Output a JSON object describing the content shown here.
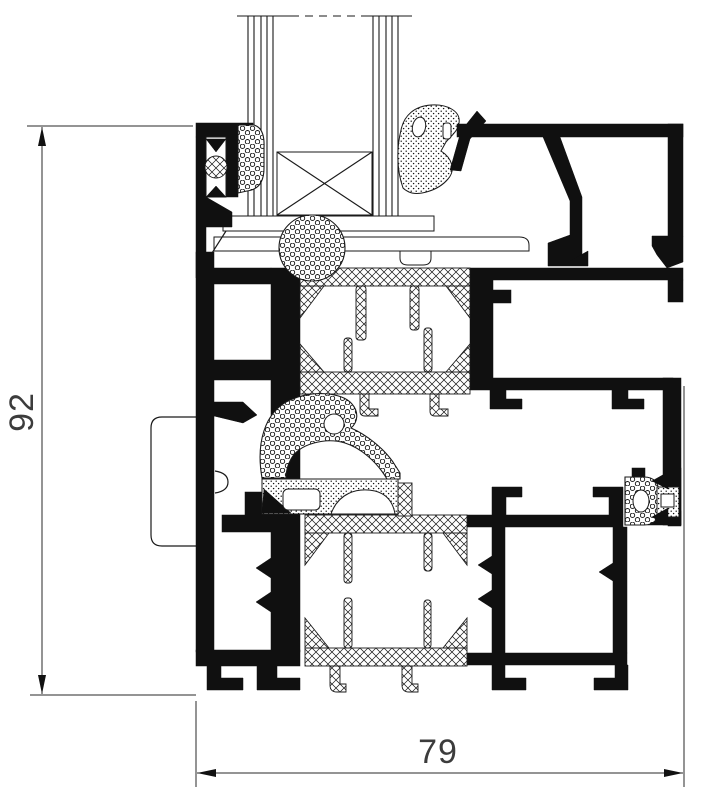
{
  "drawing": {
    "kind": "Aluminium window frame profile cross-section",
    "dimension_height": "92",
    "dimension_width": "79"
  },
  "colors": {
    "ink": "#1a1a1a",
    "aluminium": "#101010",
    "background": "#ffffff",
    "dimension_text": "#3c3c3c"
  }
}
